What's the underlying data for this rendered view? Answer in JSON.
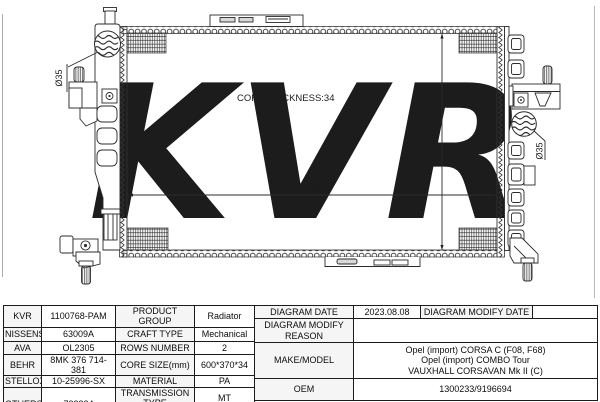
{
  "diagram": {
    "watermark": "KVR",
    "labels": {
      "core_thickness": "CORE THICKNESS:34",
      "height_dim": "370",
      "width_dim": "600",
      "port_left_diameter": "Ø35",
      "port_right_diameter": "Ø35"
    }
  },
  "table": {
    "brands": [
      {
        "brand": "KVR",
        "code": "1100768-PAM"
      },
      {
        "brand": "NISSENS",
        "code": "63009A"
      },
      {
        "brand": "AVA",
        "code": "OL2305"
      },
      {
        "brand": "BEHR",
        "code": "8MK 376 714-381"
      },
      {
        "brand": "STELLOX",
        "code": "10-25996-SX"
      },
      {
        "brand": "OTHERS",
        "code": "732824"
      }
    ],
    "specs": [
      {
        "label": "PRODUCT GROUP",
        "value": "Radiator"
      },
      {
        "label": "CRAFT TYPE",
        "value": "Mechanical"
      },
      {
        "label": "ROWS NUMBER",
        "value": "2"
      },
      {
        "label": "CORE SIZE(mm)",
        "value": "600*370*34"
      },
      {
        "label": "MATERIAL",
        "value": "PA"
      },
      {
        "label": "TRANSMISSION TYPE",
        "value": "MT"
      },
      {
        "label": "SUPPLEMENTARY",
        "value": ""
      }
    ],
    "right": {
      "diagram_date_label": "DIAGRAM DATE",
      "diagram_date": "2023.08.08",
      "diagram_modify_date_label": "DIAGRAM MODIFY DATE",
      "diagram_modify_date": "",
      "modify_reason_label": "DIAGRAM MODIFY REASON",
      "modify_reason": "",
      "make_model_label": "MAKE/MODEL",
      "make_model_lines": [
        "Opel (import) CORSA C (F08, F68)",
        "Opel (import) COMBO Tour",
        "VAUXHALL CORSAVAN Mk II (C)"
      ],
      "oem_label": "OEM",
      "oem": "1300233/9196694"
    }
  }
}
